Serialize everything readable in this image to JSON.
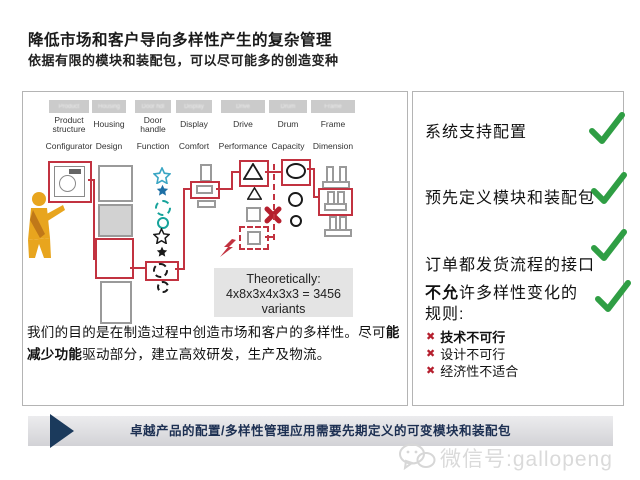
{
  "title": "降低市场和客户导向多样性产生的复杂管理",
  "subtitle": "依据有限的模块和装配包，可以尽可能多的创造变种",
  "diagram": {
    "columns": [
      {
        "ghost": "Product",
        "name": "Product structure",
        "attr": "Configurator"
      },
      {
        "ghost": "Housing",
        "name": "Housing",
        "attr": "Design"
      },
      {
        "ghost": "Door hdl",
        "name": "Door handle",
        "attr": "Function"
      },
      {
        "ghost": "Display",
        "name": "Display",
        "attr": "Comfort"
      },
      {
        "ghost": "Drive",
        "name": "Drive",
        "attr": "Performance"
      },
      {
        "ghost": "Drum",
        "name": "Drum",
        "attr": "Capacity"
      },
      {
        "ghost": "Frame",
        "name": "Frame",
        "attr": "Dimension"
      }
    ],
    "theory_box": {
      "line1": "Theoretically:",
      "line2": "4x8x3x4x3x3 = 3456",
      "line3": "variants"
    },
    "paragraph": {
      "part1": "我们的目的是在制造过程中创造市场和客户的多样性。尽可",
      "part2_bold": "能减少功能",
      "part3": "驱动部分，建立高效研发，生产及物流。"
    }
  },
  "checklist": {
    "item1": "系统支持配置",
    "item2": "预先定义模块和装配包",
    "item3": "订单都发货流程的接口",
    "item4_bold": "不允",
    "item4_rest": "许多样性变化的规则:",
    "rules": [
      "技术不可行",
      "设计不可行",
      "经济性不适合"
    ]
  },
  "footer": {
    "text": "卓越产品的配置/多样性管理应用需要先期定义的可变模块和装配包"
  },
  "watermark": {
    "text": "微信号:gallopeng"
  },
  "colors": {
    "accent_red": "#c23240",
    "check_green": "#2f9e44",
    "x_red": "#b51f2e",
    "navy": "#1b3a5c",
    "teal": "#17a39b",
    "blue_filled": "#1d6fa5",
    "cyan_outline": "#3aa6c4",
    "gray_shape": "#9a9a9a"
  }
}
